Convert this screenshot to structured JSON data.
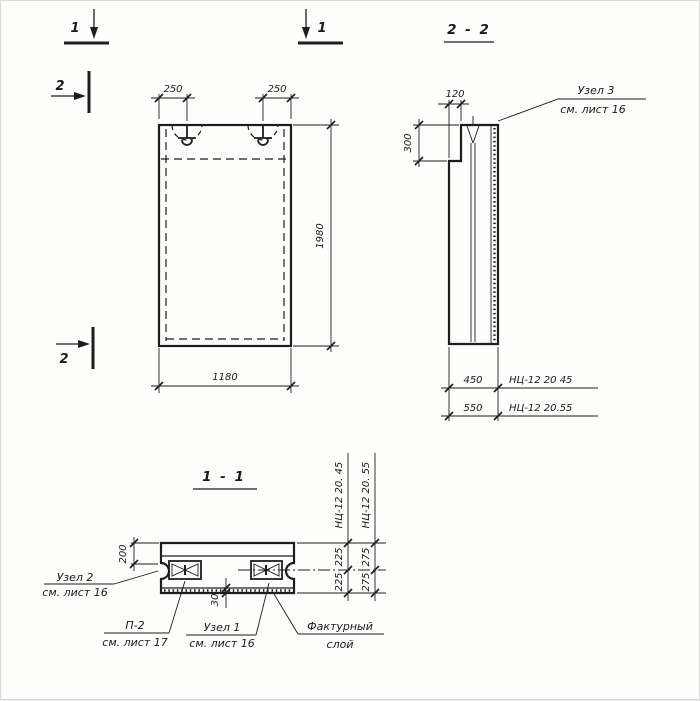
{
  "section_marks": {
    "cut1_label": "1",
    "cut2_label": "2"
  },
  "front_view": {
    "dim_hook_offset_left": "250",
    "dim_hook_offset_right": "250",
    "dim_height": "1980",
    "dim_width": "1180"
  },
  "section_2_2": {
    "title": "2 - 2",
    "dim_rebate_width": "120",
    "dim_rebate_height": "300",
    "callout_node3_line1": "Узел 3",
    "callout_node3_line2": "см. лист 16",
    "rows": [
      {
        "dim": "450",
        "label": "НЦ-12 20 45"
      },
      {
        "dim": "550",
        "label": "НЦ-12 20.55"
      }
    ]
  },
  "section_1_1": {
    "title": "1 - 1",
    "dim_edge": "200",
    "dim_facture": "30",
    "columns": [
      {
        "label": "НЦ-12 20. 45",
        "top": "225",
        "bottom": "225"
      },
      {
        "label": "НЦ-12 20. 55",
        "top": "275",
        "bottom": "275"
      }
    ],
    "callout_node2_line1": "Узел 2",
    "callout_node2_line2": "см. лист 16",
    "callout_p2_line1": "П-2",
    "callout_p2_line2": "см. лист 17",
    "callout_node1_line1": "Узел 1",
    "callout_node1_line2": "см. лист 16",
    "callout_facture_line1": "Фактурный",
    "callout_facture_line2": "слой"
  }
}
